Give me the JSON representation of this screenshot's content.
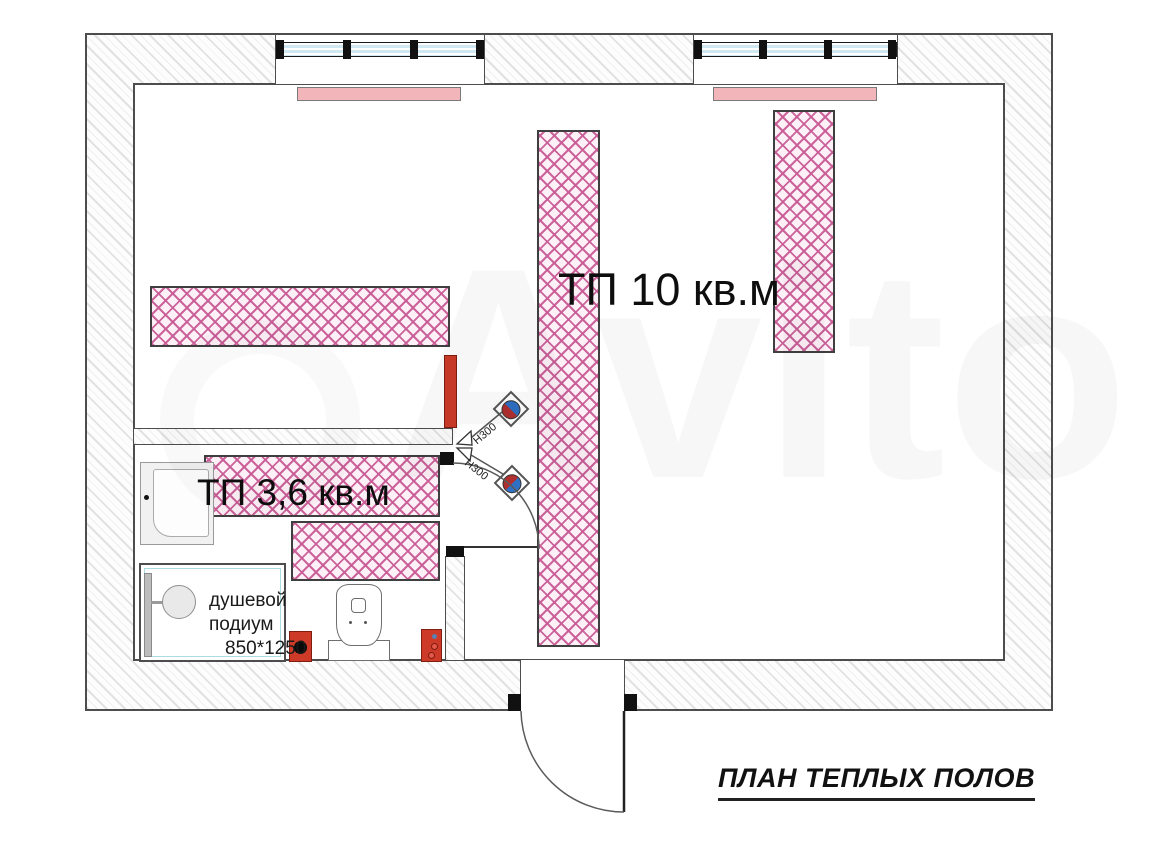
{
  "drawing": {
    "title": "ПЛАН ТЕПЛЫХ ПОЛОВ",
    "watermark": "Avito"
  },
  "zones": {
    "main": {
      "label": "ТП 10 кв.м"
    },
    "bathroom": {
      "label": "ТП 3,6 кв.м"
    }
  },
  "shower": {
    "line1": "душевой",
    "line2": "подиум",
    "line3": "850*1250"
  },
  "sensor_annotations": {
    "top": "Н300",
    "bottom": "Н300"
  },
  "colors": {
    "heated_mat_hatch": "#c95c96",
    "heated_mat_bg": "#fdf0f7",
    "wall_hatch": "#e2e2e2",
    "radiator_pink": "#f2b6ba",
    "red_unit": "#cd3b28",
    "window_glass": "#cfe8f2",
    "sensor_blue": "#2f6fc4",
    "sensor_red": "#b03030"
  }
}
